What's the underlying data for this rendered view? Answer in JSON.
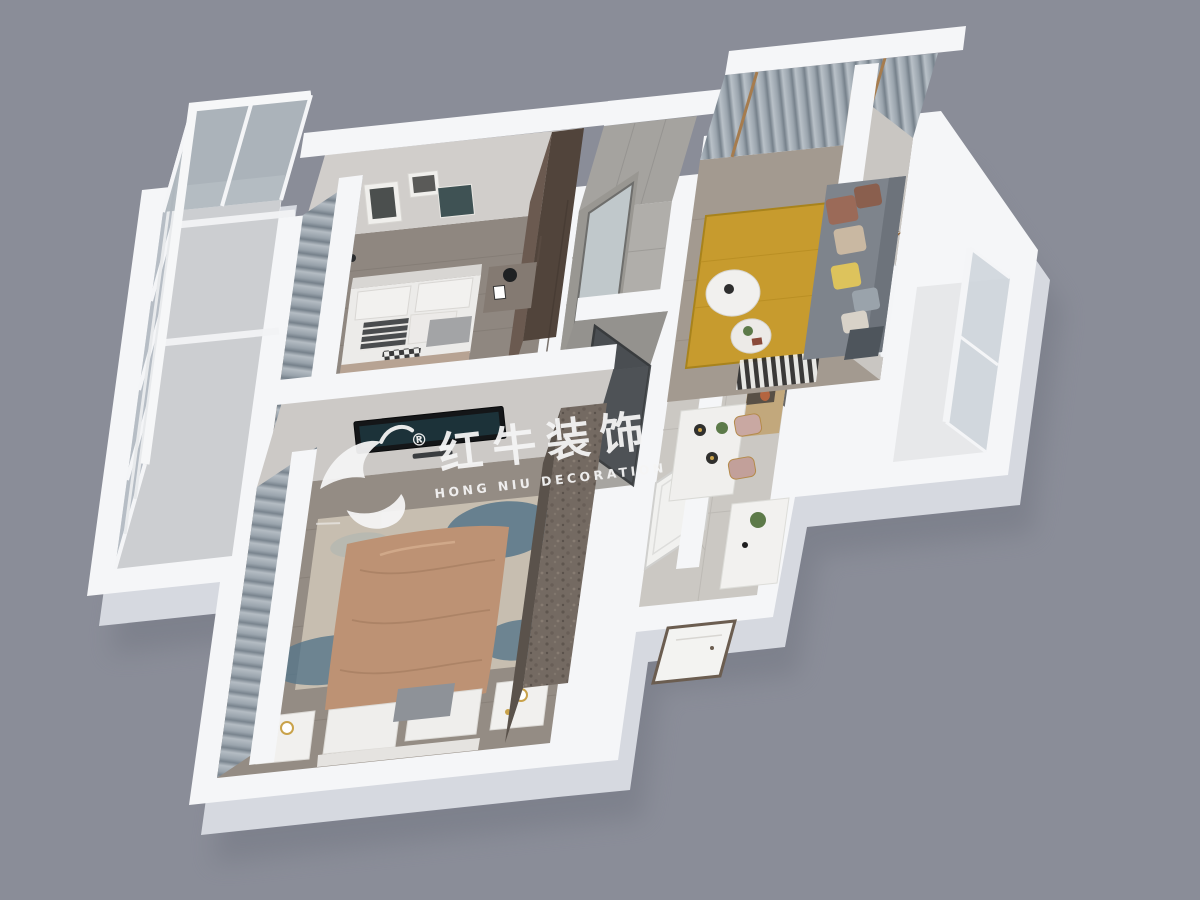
{
  "watermark": {
    "title_cn": "红牛装饰",
    "subtitle_en": "HONG NIU DECORATION",
    "registered": "®",
    "logo": "bull-swoosh-icon"
  },
  "colors": {
    "background": "#8a8d98",
    "wall": "#f5f6f8",
    "slab": "#d6d9e0",
    "shadow": "#70737f",
    "floor_bed1": "#8f8780",
    "floor_bed2": "#948c84",
    "floor_living": "#a39a90",
    "floor_hall": "#cbc8c3",
    "curtain_light": "#b4bcc3",
    "curtain_mid": "#97a1aa",
    "curtain_dark": "#76818b",
    "duvet1": "#b7a393",
    "duvet2": "#bd9274",
    "rug_living": "#c79b2e",
    "rug2_base": "#c7beb0",
    "rug2_teal": "#567689",
    "sofa": "#7e848c",
    "console_wood": "#c2a87c",
    "wardrobe_wood": "#6b5a50",
    "stone": "#746a62",
    "gold": "#c9a24a",
    "watermark": "#f5f5f5",
    "tv": "#141618",
    "glass": "#b4bcc3",
    "art_wood": "#c08a4f"
  }
}
